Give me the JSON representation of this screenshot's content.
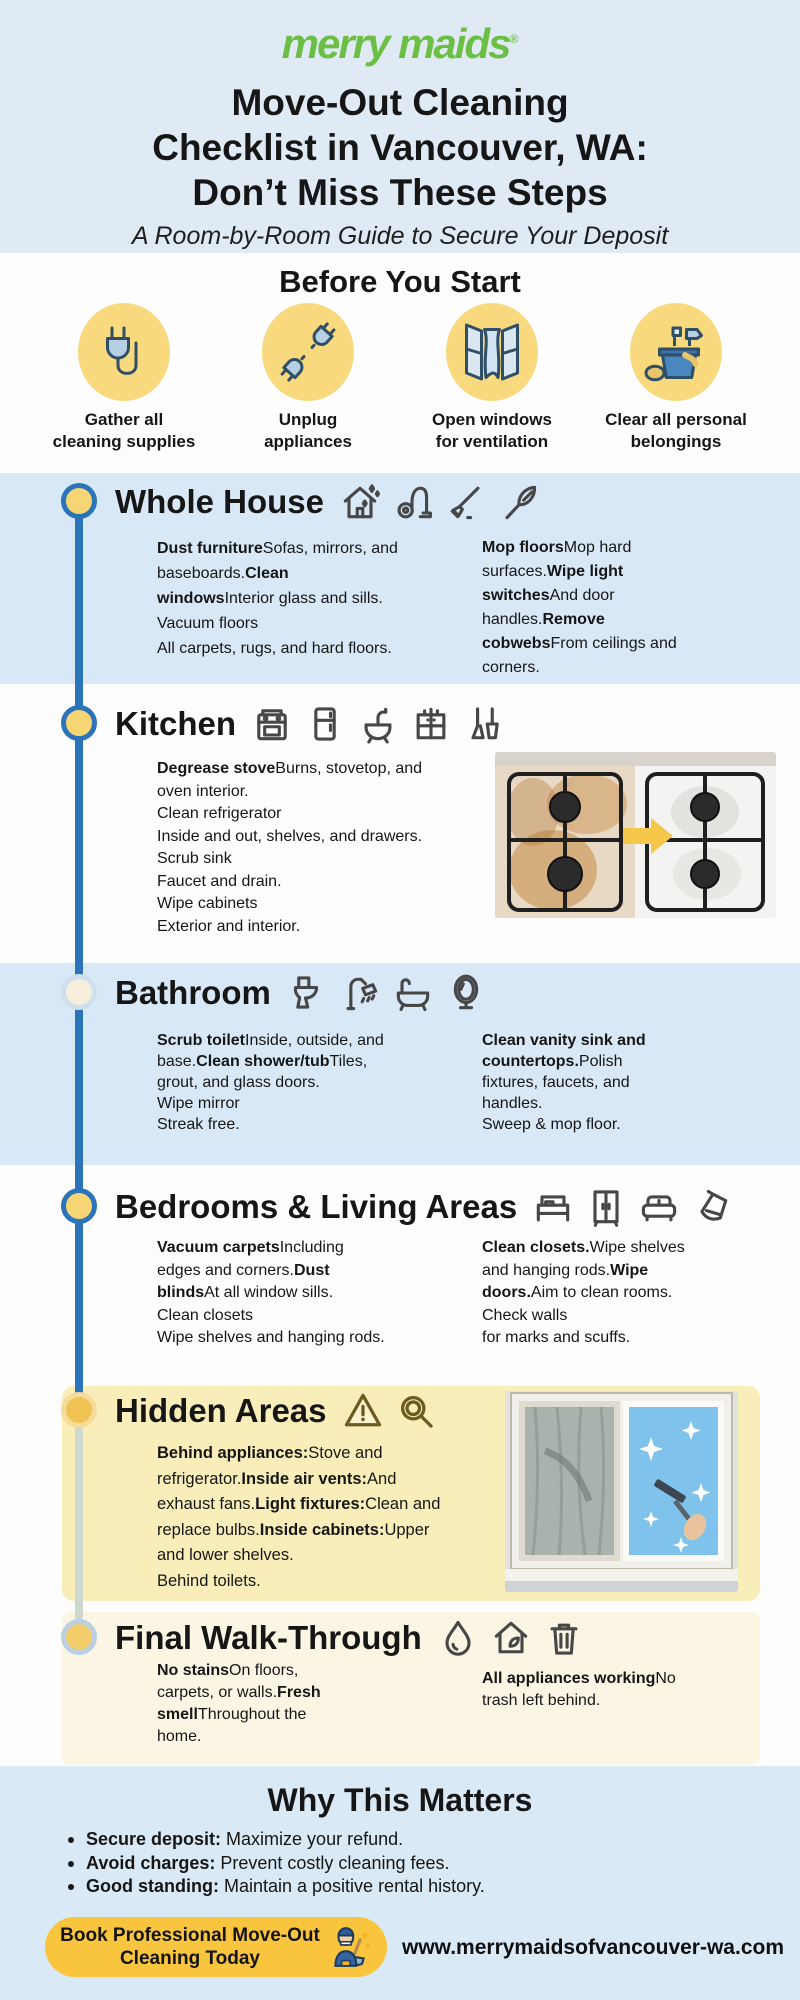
{
  "colors": {
    "brand_green": "#6cbf45",
    "timeline_blue": "#2b74b9",
    "band_blue": "#d8e8f6",
    "hidden_box_yellow": "#f9eeba",
    "final_box_cream": "#fbf6e4",
    "button_yellow": "#f9c53f",
    "dot_yellow": "#f6d575"
  },
  "brand": {
    "logo": "merry maids",
    "registered_mark": "®"
  },
  "header": {
    "title": "Move-Out Cleaning\nChecklist in Vancouver, WA:\nDon’t Miss These Steps",
    "subtitle": "A Room-by-Room Guide to Secure Your Deposit"
  },
  "before": {
    "heading": "Before You Start",
    "items": [
      {
        "icon": "power-plug-cord-icon",
        "label": "Gather all\ncleaning supplies"
      },
      {
        "icon": "unplugged-plugs-icon",
        "label": "Unplug\nappliances"
      },
      {
        "icon": "open-window-icon",
        "label": "Open windows\nfor ventilation"
      },
      {
        "icon": "cleaning-bucket-icon",
        "label": "Clear all personal\nbelongings"
      }
    ]
  },
  "sections": [
    {
      "title": "Whole House",
      "icons": [
        "house-sparkle-icon",
        "vacuum-icon",
        "push-broom-icon",
        "feather-duster-icon"
      ],
      "columns": [
        [
          {
            "b": "Dust furniture"
          },
          {
            "t": "Sofas, mirrors, and\nbaseboards."
          },
          {
            "b": "Clean\nwindows"
          },
          {
            "t": "Interior glass and sills.\nVacuum floors\nAll carpets, rugs, and hard floors."
          }
        ],
        [
          {
            "b": "Mop floors"
          },
          {
            "t": "Mop hard\nsurfaces."
          },
          {
            "b": "Wipe light\nswitches"
          },
          {
            "t": "And door\nhandles."
          },
          {
            "b": "Remove\ncobwebs"
          },
          {
            "t": "From ceilings and\ncorners."
          }
        ]
      ]
    },
    {
      "title": "Kitchen",
      "icons": [
        "stove-icon",
        "refrigerator-icon",
        "sink-icon",
        "cabinet-icon",
        "broom-dustpan-icon"
      ],
      "columns": [
        [
          {
            "b": "Degrease stove"
          },
          {
            "t": "Burns, stovetop, and\noven interior.\nClean refrigerator\nInside and out, shelves, and drawers.\nScrub sink\nFaucet and drain.\nWipe cabinets\nExterior and interior."
          }
        ]
      ]
    },
    {
      "title": "Bathroom",
      "icons": [
        "toilet-icon",
        "shower-icon",
        "bathtub-icon",
        "mirror-icon"
      ],
      "columns": [
        [
          {
            "b": "Scrub toilet"
          },
          {
            "t": "Inside, outside, and\nbase."
          },
          {
            "b": "Clean shower/tub"
          },
          {
            "t": "Tiles,\ngrout, and glass doors.\nWipe mirror\nStreak free."
          }
        ],
        [
          {
            "b": "Clean vanity sink and\ncountertops."
          },
          {
            "t": "Polish\nfixtures, faucets, and\nhandles.\nSweep & mop floor."
          }
        ]
      ]
    },
    {
      "title": "Bedrooms & Living Areas",
      "icons": [
        "bed-icon",
        "wardrobe-icon",
        "sofa-icon",
        "dustpan-icon"
      ],
      "columns": [
        [
          {
            "b": "Vacuum carpets"
          },
          {
            "t": "Including\nedges and corners."
          },
          {
            "b": "Dust\nblinds"
          },
          {
            "t": "At all window sills.\nClean closets\nWipe shelves and hanging rods."
          }
        ],
        [
          {
            "b": "Clean closets."
          },
          {
            "t": "Wipe shelves\nand hanging rods."
          },
          {
            "b": "Wipe\ndoors."
          },
          {
            "t": "Aim to clean rooms.\nCheck walls\nfor marks and scuffs."
          }
        ]
      ]
    },
    {
      "title": "Hidden Areas",
      "icons": [
        "warning-icon",
        "magnifier-icon"
      ],
      "columns": [
        [
          {
            "b": "Behind appliances:"
          },
          {
            "t": "Stove and\nrefrigerator."
          },
          {
            "b": "Inside air vents:"
          },
          {
            "t": "And\nexhaust fans."
          },
          {
            "b": "Light fixtures:"
          },
          {
            "t": "Clean and\nreplace bulbs."
          },
          {
            "b": "Inside cabinets:"
          },
          {
            "t": "Upper\nand lower shelves.\nBehind toilets."
          }
        ]
      ]
    },
    {
      "title": "Final Walk-Through",
      "icons": [
        "droplet-icon",
        "house-leaf-icon",
        "trash-icon"
      ],
      "columns": [
        [
          {
            "b": "No stains"
          },
          {
            "t": "On floors,\ncarpets, or walls."
          },
          {
            "b": "Fresh\nsmell"
          },
          {
            "t": "Throughout the\nhome."
          }
        ],
        [
          {
            "b": "All appliances working"
          },
          {
            "t": "No\ntrash left behind."
          }
        ]
      ]
    }
  ],
  "why": {
    "heading": "Why This Matters",
    "bullets": [
      [
        {
          "b": "Secure deposit:"
        },
        {
          "t": " Maximize your refund."
        }
      ],
      [
        {
          "b": "Avoid charges:"
        },
        {
          "t": " Prevent costly cleaning fees."
        }
      ],
      [
        {
          "b": "Good standing:"
        },
        {
          "t": " Maintain a positive rental history."
        }
      ]
    ]
  },
  "footer": {
    "cta_label": "Book Professional Move-Out\nCleaning Today",
    "url": "www.merrymaidsofvancouver-wa.com"
  }
}
